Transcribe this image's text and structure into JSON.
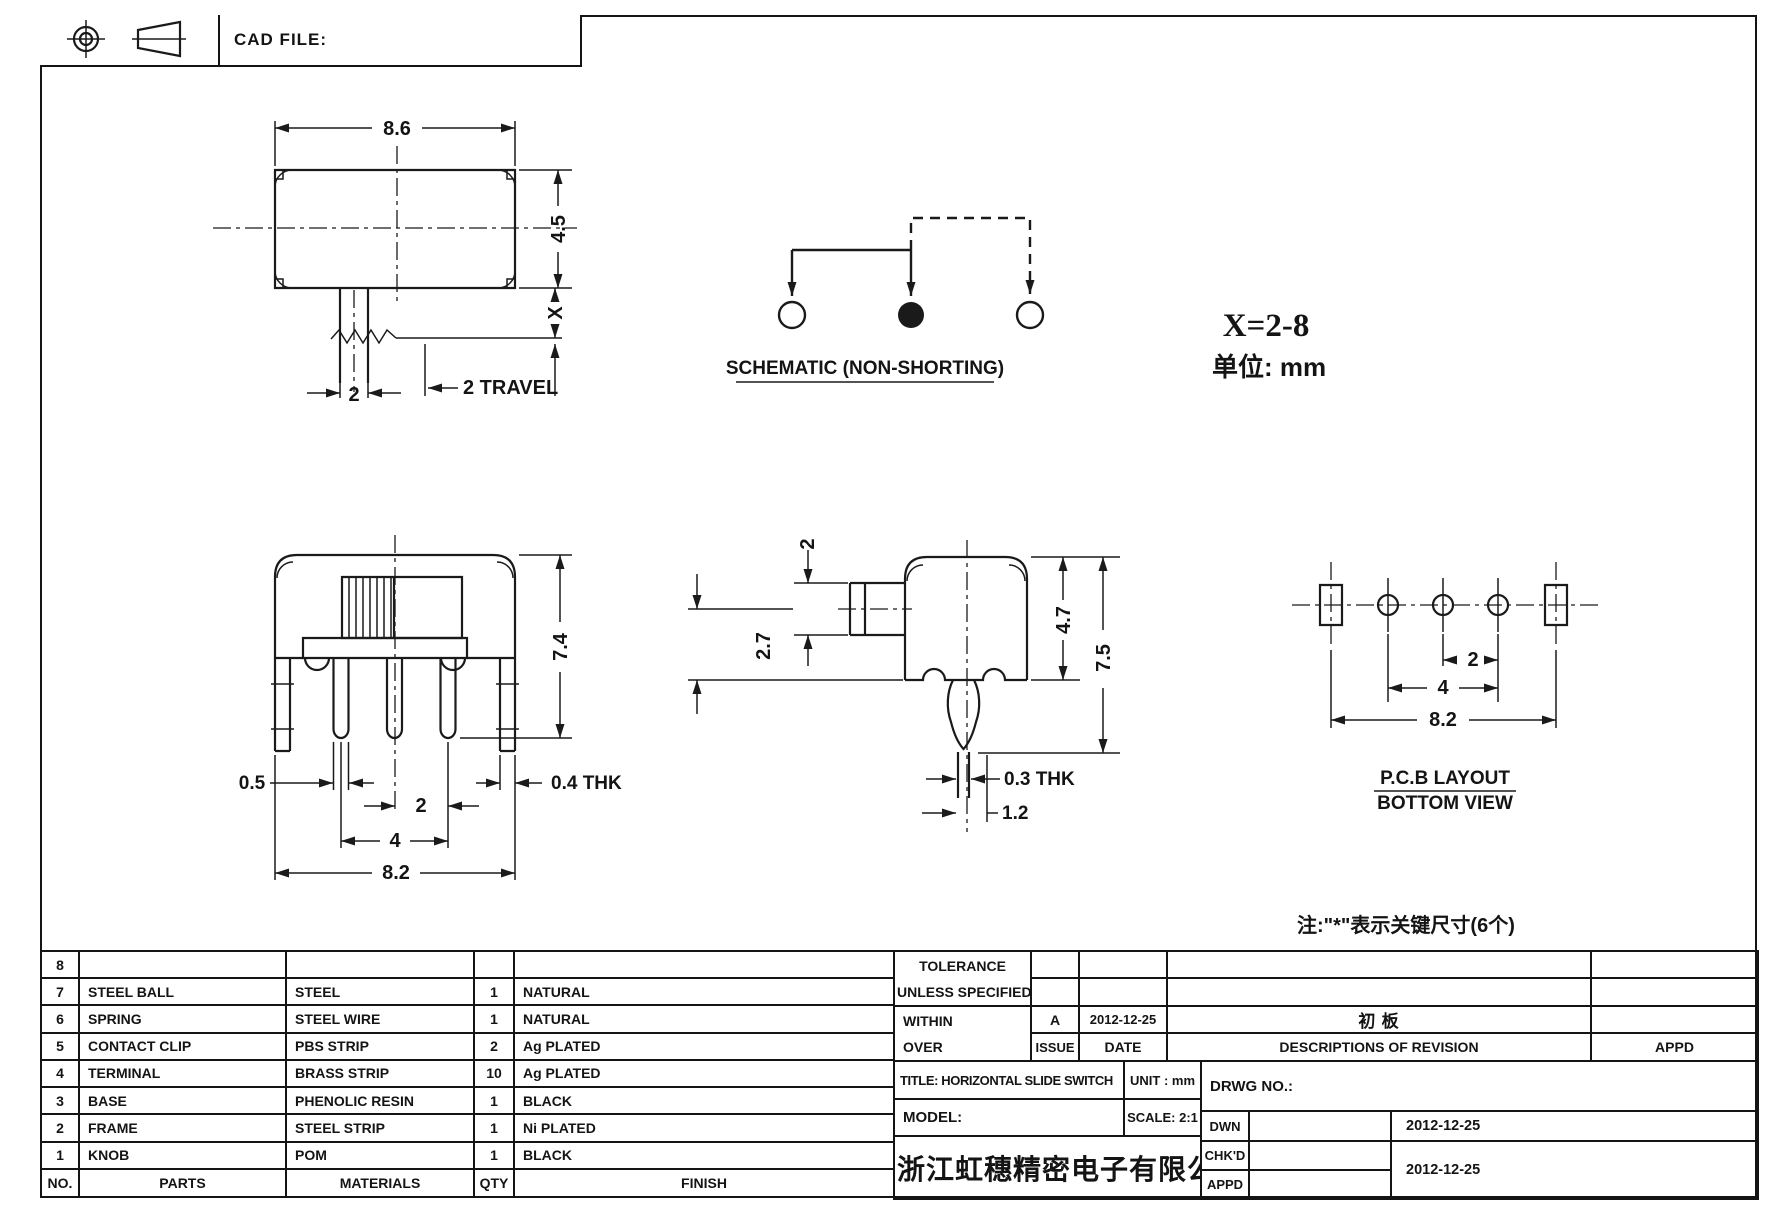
{
  "header": {
    "cad_file": "CAD FILE:"
  },
  "drawing": {
    "top_view": {
      "w": "8.6",
      "h": "4.5",
      "x_dim": "X",
      "travel": "2 TRAVEL",
      "stem": "2"
    },
    "schematic": {
      "label": "SCHEMATIC (NON-SHORTING)"
    },
    "notes": {
      "x_range": "X=2-8",
      "unit": "单位: mm",
      "key": "注:\"*\"表示关键尺寸(6个)"
    },
    "front_view": {
      "h": "7.4",
      "pin": "0.5",
      "thk": "0.4 THK",
      "pitch": "2",
      "span": "4",
      "total": "8.2"
    },
    "side_view": {
      "knob": "2",
      "offset": "2.7",
      "body": "4.7",
      "total": "7.5",
      "thk": "0.3 THK",
      "tip": "1.2"
    },
    "pcb": {
      "label1": "P.C.B LAYOUT",
      "label2": "BOTTOM VIEW",
      "pitch": "2",
      "span": "4",
      "total": "8.2"
    }
  },
  "parts_table": {
    "headers": {
      "no": "NO.",
      "parts": "PARTS",
      "materials": "MATERIALS",
      "qty": "QTY",
      "finish": "FINISH"
    },
    "rows": [
      {
        "no": "8",
        "parts": "",
        "materials": "",
        "qty": "",
        "finish": ""
      },
      {
        "no": "7",
        "parts": "STEEL BALL",
        "materials": "STEEL",
        "qty": "1",
        "finish": "NATURAL"
      },
      {
        "no": "6",
        "parts": "SPRING",
        "materials": "STEEL WIRE",
        "qty": "1",
        "finish": "NATURAL"
      },
      {
        "no": "5",
        "parts": "CONTACT CLIP",
        "materials": "PBS STRIP",
        "qty": "2",
        "finish": "Ag PLATED"
      },
      {
        "no": "4",
        "parts": "TERMINAL",
        "materials": "BRASS STRIP",
        "qty": "10",
        "finish": "Ag PLATED"
      },
      {
        "no": "3",
        "parts": "BASE",
        "materials": "PHENOLIC RESIN",
        "qty": "1",
        "finish": "BLACK"
      },
      {
        "no": "2",
        "parts": "FRAME",
        "materials": "STEEL STRIP",
        "qty": "1",
        "finish": "Ni PLATED"
      },
      {
        "no": "1",
        "parts": "KNOB",
        "materials": "POM",
        "qty": "1",
        "finish": "BLACK"
      }
    ]
  },
  "title_block": {
    "tolerance1": "TOLERANCE",
    "tolerance2": "UNLESS  SPECIFIED",
    "within": "WITHIN",
    "over": "OVER",
    "issue_value": "A",
    "issue_date": "2012-12-25",
    "revision_desc": "初 板",
    "issue_label": "ISSUE",
    "date_label": "DATE",
    "desc_label": "DESCRIPTIONS OF REVISION",
    "appd_label": "APPD",
    "title": "TITLE: HORIZONTAL SLIDE SWITCH",
    "unit": "UNIT : mm",
    "model": "MODEL:",
    "scale": "SCALE: 2:1",
    "drwg_no": "DRWG NO.:",
    "company": "浙江虹穗精密电子有限公司",
    "dwn": "DWN",
    "chkd": "CHK'D",
    "appd": "APPD",
    "dwn_date": "2012-12-25",
    "chkd_date": "2012-12-25"
  }
}
